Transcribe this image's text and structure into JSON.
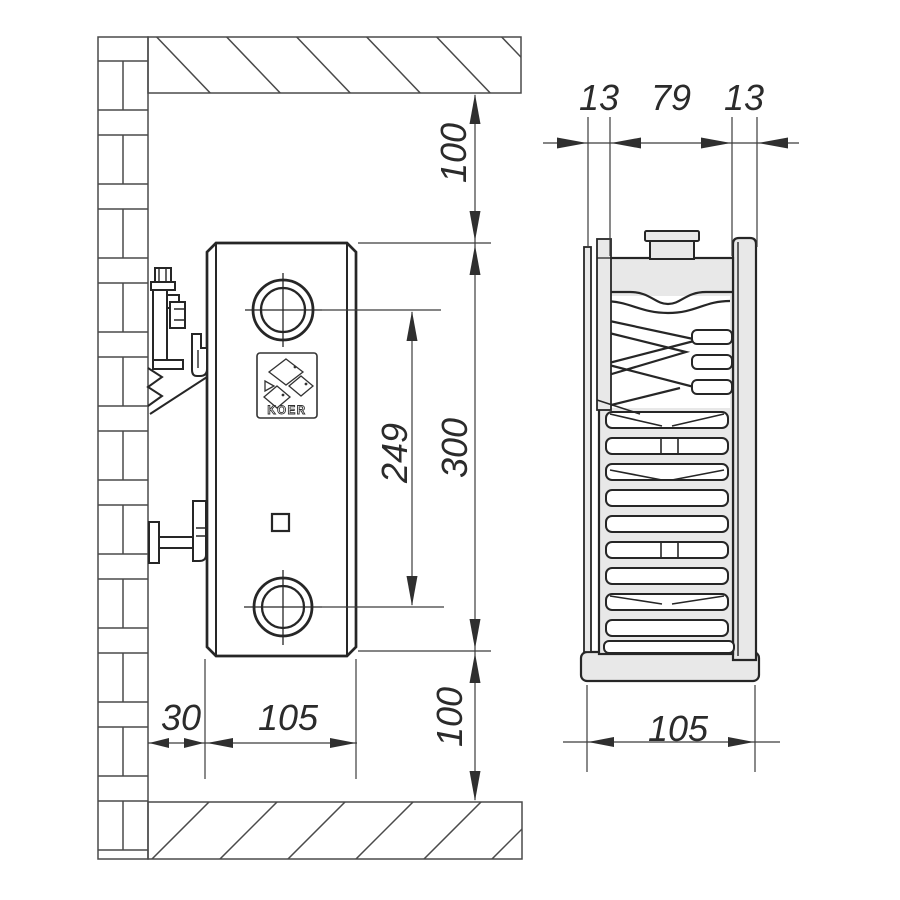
{
  "title": "Radiator mounting technical drawing",
  "brand": "KOER",
  "side_view": {
    "dim_top_clearance": "100",
    "dim_height": "300",
    "dim_axis_spacing": "249",
    "dim_bottom_clearance": "100",
    "dim_wall_offset": "30",
    "dim_depth": "105"
  },
  "front_view": {
    "dim_front_panel": "13",
    "dim_core": "79",
    "dim_back_panel": "13",
    "dim_width": "105"
  },
  "colors": {
    "line": "#2f2f2f",
    "wall_line": "#4a4a4a",
    "metal_fill": "#e8e8e8",
    "background": "#ffffff"
  }
}
